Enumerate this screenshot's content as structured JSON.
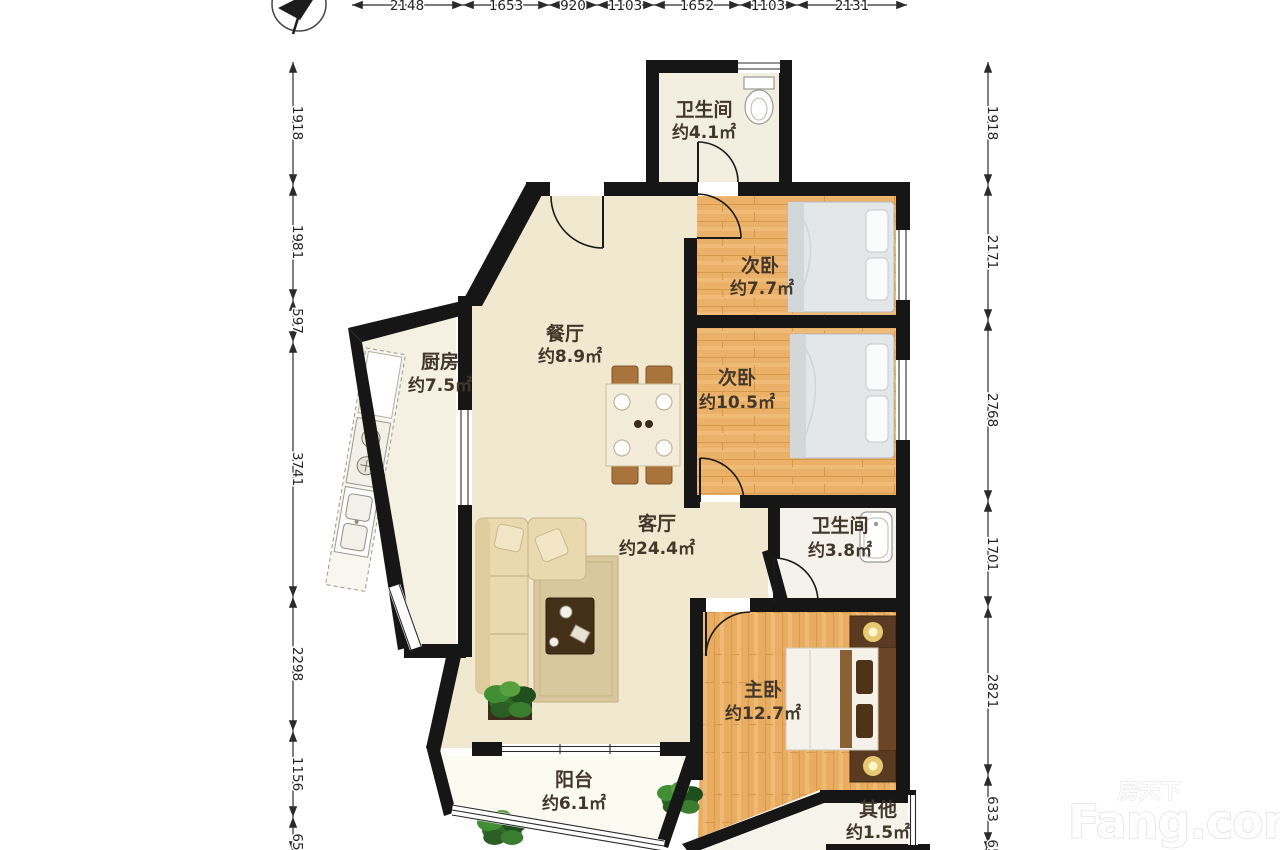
{
  "plan": {
    "type": "floor-plan",
    "source_watermark": true
  },
  "watermark": {
    "brand_cn": "房天下",
    "brand_en": "Fang.com"
  },
  "compass": {
    "icon": "north-arrow"
  },
  "rooms": [
    {
      "id": "bath-top",
      "name": "卫生间",
      "area": "约4.1㎡"
    },
    {
      "id": "bedroom-2a",
      "name": "次卧",
      "area": "约7.7㎡"
    },
    {
      "id": "bedroom-2b",
      "name": "次卧",
      "area": "约10.5㎡"
    },
    {
      "id": "dining",
      "name": "餐厅",
      "area": "约8.9㎡"
    },
    {
      "id": "kitchen",
      "name": "厨房",
      "area": "约7.5㎡"
    },
    {
      "id": "living",
      "name": "客厅",
      "area": "约24.4㎡"
    },
    {
      "id": "bath-2",
      "name": "卫生间",
      "area": "约3.8㎡"
    },
    {
      "id": "master",
      "name": "主卧",
      "area": "约12.7㎡"
    },
    {
      "id": "balcony",
      "name": "阳台",
      "area": "约6.1㎡"
    },
    {
      "id": "other",
      "name": "其他",
      "area": "约1.5㎡"
    }
  ],
  "dimensions": {
    "top": [
      "2148",
      "1653",
      "920",
      "1103",
      "1652",
      "1103",
      "2131"
    ],
    "left": [
      "1918",
      "1981",
      "597",
      "3741",
      "2298",
      "1156",
      "65"
    ],
    "right": [
      "1918",
      "2171",
      "2768",
      "1701",
      "2821",
      "633",
      "65"
    ]
  },
  "colors": {
    "wall": "#161616",
    "cream_floor": "#f0e9cf",
    "kitchen_floor": "#f4f0e2",
    "bath_floor": "#f4f2ea",
    "wood_floor": "#ecb169",
    "bed": "#e4e7e8",
    "label": "#42372a"
  }
}
